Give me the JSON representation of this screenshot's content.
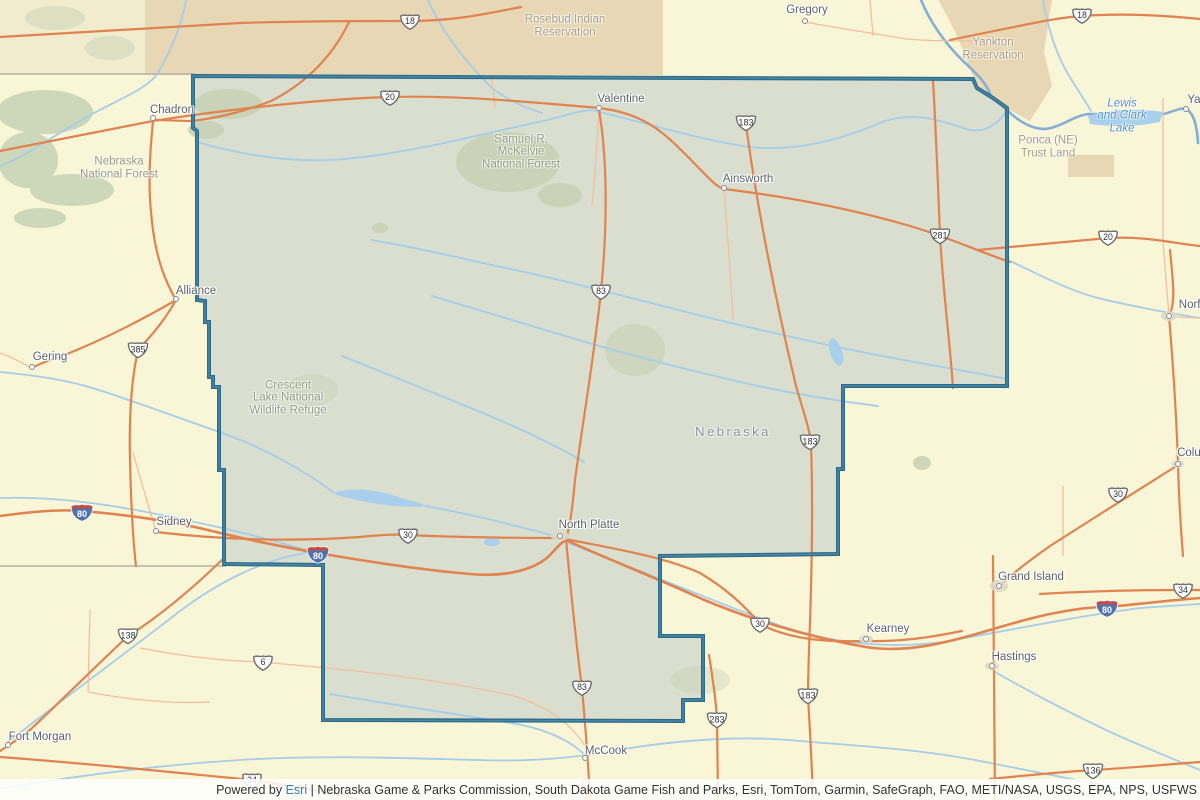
{
  "map": {
    "colors": {
      "base_land": "#f9f6d8",
      "selected_region_fill": "#dadecf",
      "selected_region_border": "#2b6b8b",
      "reservation_tan": "#e8d7b5",
      "sd_west_strip": "#f2ecce",
      "forest_green": "#cdd7ba",
      "river_blue": "#a3cde9",
      "missouri_blue": "#84aed4",
      "road_orange": "#e0834e",
      "road_minor": "#f0c09c",
      "state_line_grey": "#b5b0a7",
      "interstate_blue": "#4f74ac",
      "interstate_red": "#c14c48",
      "city_label_grey": "#5d6268",
      "esri_link_blue": "#2e82ad"
    },
    "cities": [
      {
        "name": "Chadron",
        "dot": [
          153,
          118
        ],
        "label": [
          172,
          110
        ]
      },
      {
        "name": "Valentine",
        "dot": [
          599,
          108
        ],
        "label": [
          621,
          99
        ]
      },
      {
        "name": "Ainsworth",
        "dot": [
          724,
          188
        ],
        "label": [
          748,
          179
        ]
      },
      {
        "name": "Gregory",
        "dot": [
          805,
          21
        ],
        "label": [
          807,
          10
        ]
      },
      {
        "name": "Alliance",
        "dot": [
          176,
          299
        ],
        "label": [
          196,
          291
        ]
      },
      {
        "name": "Gering",
        "dot": [
          32,
          367
        ],
        "label": [
          50,
          357
        ]
      },
      {
        "name": "Sidney",
        "dot": [
          156,
          531
        ],
        "label": [
          174,
          522
        ]
      },
      {
        "name": "North Platte",
        "dot": [
          560,
          536
        ],
        "label": [
          589,
          525
        ],
        "big": true
      },
      {
        "name": "Grand Island",
        "dot": [
          999,
          586
        ],
        "label": [
          1031,
          577
        ],
        "big": true
      },
      {
        "name": "Kearney",
        "dot": [
          866,
          639
        ],
        "label": [
          888,
          629
        ],
        "big": true
      },
      {
        "name": "Hastings",
        "dot": [
          992,
          666
        ],
        "label": [
          1014,
          657
        ],
        "big": true
      },
      {
        "name": "McCook",
        "dot": [
          585,
          758
        ],
        "label": [
          606,
          751
        ]
      },
      {
        "name": "Fort Morgan",
        "dot": [
          8,
          745
        ],
        "label": [
          40,
          737
        ]
      },
      {
        "name": "Norfolk",
        "dot": [
          1169,
          316
        ],
        "label": [
          1197,
          305
        ],
        "big": true
      },
      {
        "name": "Yankton",
        "dot": [
          1186,
          109
        ],
        "label": [
          1208,
          100
        ]
      },
      {
        "name": "Columbus",
        "dot": [
          1178,
          464
        ],
        "label": [
          1203,
          453
        ],
        "big": true
      }
    ],
    "us_route_shields": [
      {
        "n": "18",
        "x": 410,
        "y": 21
      },
      {
        "n": "20",
        "x": 390,
        "y": 97
      },
      {
        "n": "18",
        "x": 1082,
        "y": 15
      },
      {
        "n": "183",
        "x": 746,
        "y": 122
      },
      {
        "n": "281",
        "x": 940,
        "y": 235
      },
      {
        "n": "20",
        "x": 1108,
        "y": 237
      },
      {
        "n": "83",
        "x": 601,
        "y": 291
      },
      {
        "n": "385",
        "x": 138,
        "y": 349
      },
      {
        "n": "183",
        "x": 810,
        "y": 441
      },
      {
        "n": "30",
        "x": 1118,
        "y": 494
      },
      {
        "n": "30",
        "x": 408,
        "y": 535
      },
      {
        "n": "30",
        "x": 760,
        "y": 624
      },
      {
        "n": "34",
        "x": 1183,
        "y": 590
      },
      {
        "n": "138",
        "x": 128,
        "y": 635
      },
      {
        "n": "6",
        "x": 263,
        "y": 662
      },
      {
        "n": "83",
        "x": 582,
        "y": 687
      },
      {
        "n": "183",
        "x": 808,
        "y": 695
      },
      {
        "n": "283",
        "x": 717,
        "y": 719
      },
      {
        "n": "136",
        "x": 1093,
        "y": 770
      },
      {
        "n": "34",
        "x": 252,
        "y": 780
      }
    ],
    "interstate_shields": [
      {
        "n": "80",
        "x": 82,
        "y": 511
      },
      {
        "n": "80",
        "x": 318,
        "y": 553
      },
      {
        "n": "80",
        "x": 1107,
        "y": 607
      }
    ],
    "area_labels": [
      {
        "lines": [
          "Rosebud Indian",
          "Reservation"
        ],
        "x": 565,
        "y": 20,
        "style": "reservation"
      },
      {
        "lines": [
          "Yankton",
          "Reservation"
        ],
        "x": 993,
        "y": 43,
        "style": "reservation"
      },
      {
        "lines": [
          "Ponca (NE)",
          "Trust Land"
        ],
        "x": 1048,
        "y": 141,
        "style": "reservation"
      },
      {
        "lines": [
          "Nebraska",
          "National Forest"
        ],
        "x": 119,
        "y": 162,
        "style": "forest"
      },
      {
        "lines": [
          "Samuel R.",
          "McKelvie",
          "National Forest"
        ],
        "x": 521,
        "y": 139,
        "style": "forest"
      },
      {
        "lines": [
          "Crescent",
          "Lake National",
          "Wildlife Refuge"
        ],
        "x": 288,
        "y": 385,
        "style": "forest"
      },
      {
        "lines": [
          "Lewis",
          "and Clark",
          "Lake"
        ],
        "x": 1122,
        "y": 103,
        "style": "water"
      },
      {
        "lines": [
          "Nebraska"
        ],
        "x": 733,
        "y": 432,
        "style": "state"
      }
    ]
  },
  "attribution": {
    "prefix": "Powered by",
    "link": "Esri",
    "divider": "|",
    "sources": "Nebraska Game & Parks Commission, South Dakota Game Fish and Parks, Esri, TomTom, Garmin, SafeGraph, FAO, METI/NASA, USGS, EPA, NPS, USFWS"
  }
}
